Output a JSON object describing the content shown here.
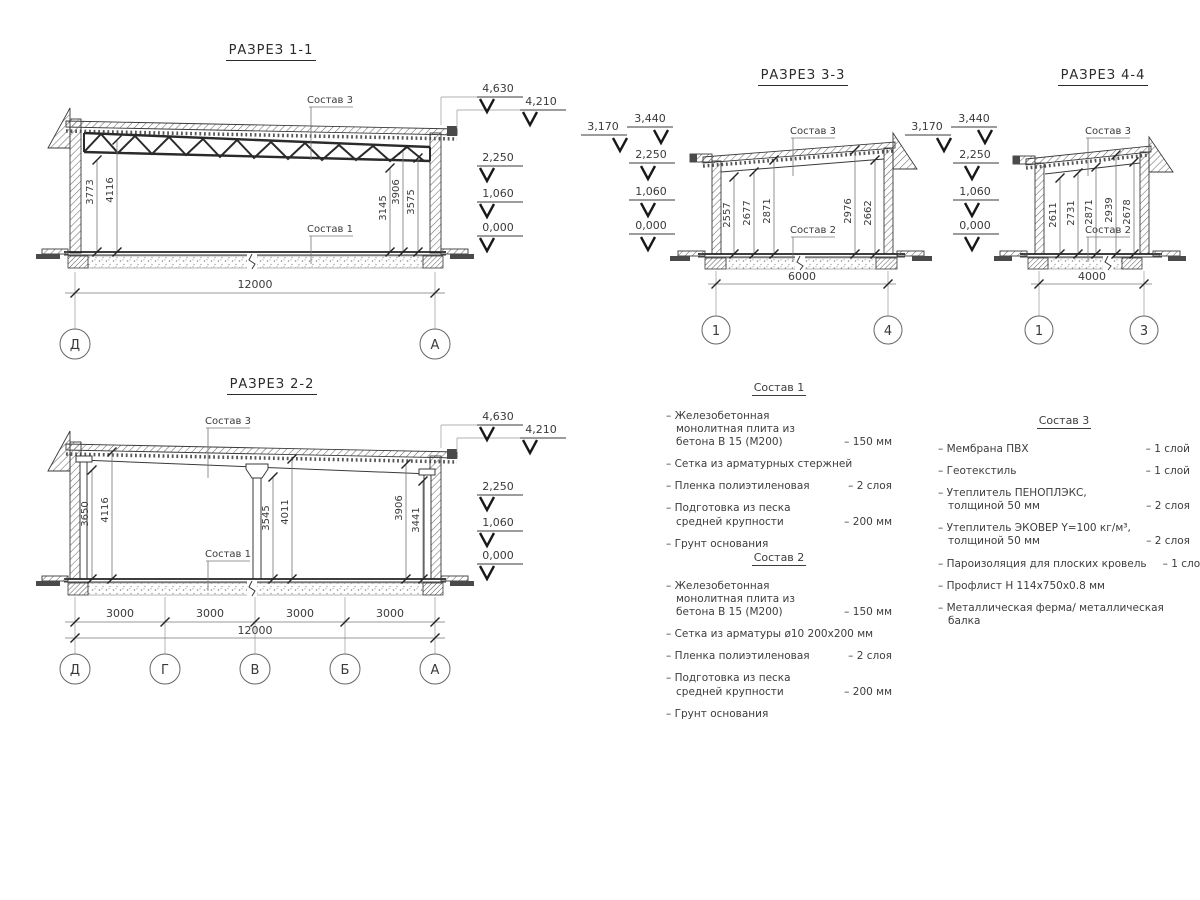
{
  "sections": {
    "s11": {
      "title": "РАЗРЕЗ 1-1",
      "top_label": "Состав 3",
      "bottom_label": "Состав 1",
      "dims": [
        "3773",
        "4116",
        "3145",
        "3906",
        "3575"
      ],
      "elevations": [
        "4,630",
        "4,210",
        "2,250",
        "1,060",
        "0,000"
      ],
      "width_dim": "12000",
      "grid": [
        "Д",
        "А"
      ]
    },
    "s22": {
      "title": "РАЗРЕЗ 2-2",
      "top_label": "Состав 3",
      "bottom_label": "Состав 1",
      "dims": [
        "3650",
        "4116",
        "3545",
        "4011",
        "3906",
        "3441"
      ],
      "elevations": [
        "4,630",
        "4,210",
        "2,250",
        "1,060",
        "0,000"
      ],
      "span_dims": [
        "3000",
        "3000",
        "3000",
        "3000"
      ],
      "width_dim": "12000",
      "grid": [
        "Д",
        "Г",
        "В",
        "Б",
        "А"
      ]
    },
    "s33": {
      "title": "РАЗРЕЗ 3-3",
      "top_label": "Состав 3",
      "bottom_label": "Состав 2",
      "dims": [
        "2557",
        "2677",
        "2871",
        "2976",
        "2662"
      ],
      "elevations": [
        "3,170",
        "3,440",
        "2,250",
        "1,060",
        "0,000"
      ],
      "width_dim": "6000",
      "grid": [
        "1",
        "4"
      ]
    },
    "s44": {
      "title": "РАЗРЕЗ 4-4",
      "top_label": "Состав 3",
      "bottom_label": "Состав 2",
      "dims": [
        "2611",
        "2731",
        "2871",
        "2939",
        "2678"
      ],
      "elevations": [
        "3,170",
        "3,440",
        "2,250",
        "1,060",
        "0,000"
      ],
      "width_dim": "4000",
      "grid": [
        "1",
        "3"
      ]
    }
  },
  "compositions": {
    "c1": {
      "title": "Состав 1",
      "items": [
        {
          "name": "Железобетонная  монолитная плита из бетона В 15 (М200)",
          "value": "150 мм"
        },
        {
          "name": "Сетка из арматурных стержней",
          "value": ""
        },
        {
          "name": "Пленка полиэтиленовая",
          "value": "2 слоя"
        },
        {
          "name": "Подготовка из песка средней крупности",
          "value": "200 мм"
        },
        {
          "name": "Грунт основания",
          "value": ""
        }
      ]
    },
    "c2": {
      "title": "Состав 2",
      "items": [
        {
          "name": "Железобетонная  монолитная плита из бетона В 15 (М200)",
          "value": "150 мм"
        },
        {
          "name": "Сетка из арматуры ø10 200х200 мм",
          "value": ""
        },
        {
          "name": "Пленка полиэтиленовая",
          "value": "2 слоя"
        },
        {
          "name": "Подготовка из песка средней крупности",
          "value": "200 мм"
        },
        {
          "name": "Грунт основания",
          "value": ""
        }
      ]
    },
    "c3": {
      "title": "Состав 3",
      "items": [
        {
          "name": "Мембрана ПВХ",
          "value": "1 слой"
        },
        {
          "name": "Геотекстиль",
          "value": "1 слой"
        },
        {
          "name": "Утеплитель ПЕНОПЛЭКС, толщиной 50 мм",
          "value": "2 слоя"
        },
        {
          "name": "Утеплитель ЭКОВЕР Y=100 кг/м³, толщиной 50 мм",
          "value": "2 слоя"
        },
        {
          "name": "Пароизоляция для плоских кровель",
          "value": "1 слой"
        },
        {
          "name": "Профлист Н 114х750х0.8 мм",
          "value": ""
        },
        {
          "name": "Металлическая ферма/ металлическая балка",
          "value": ""
        }
      ]
    }
  }
}
